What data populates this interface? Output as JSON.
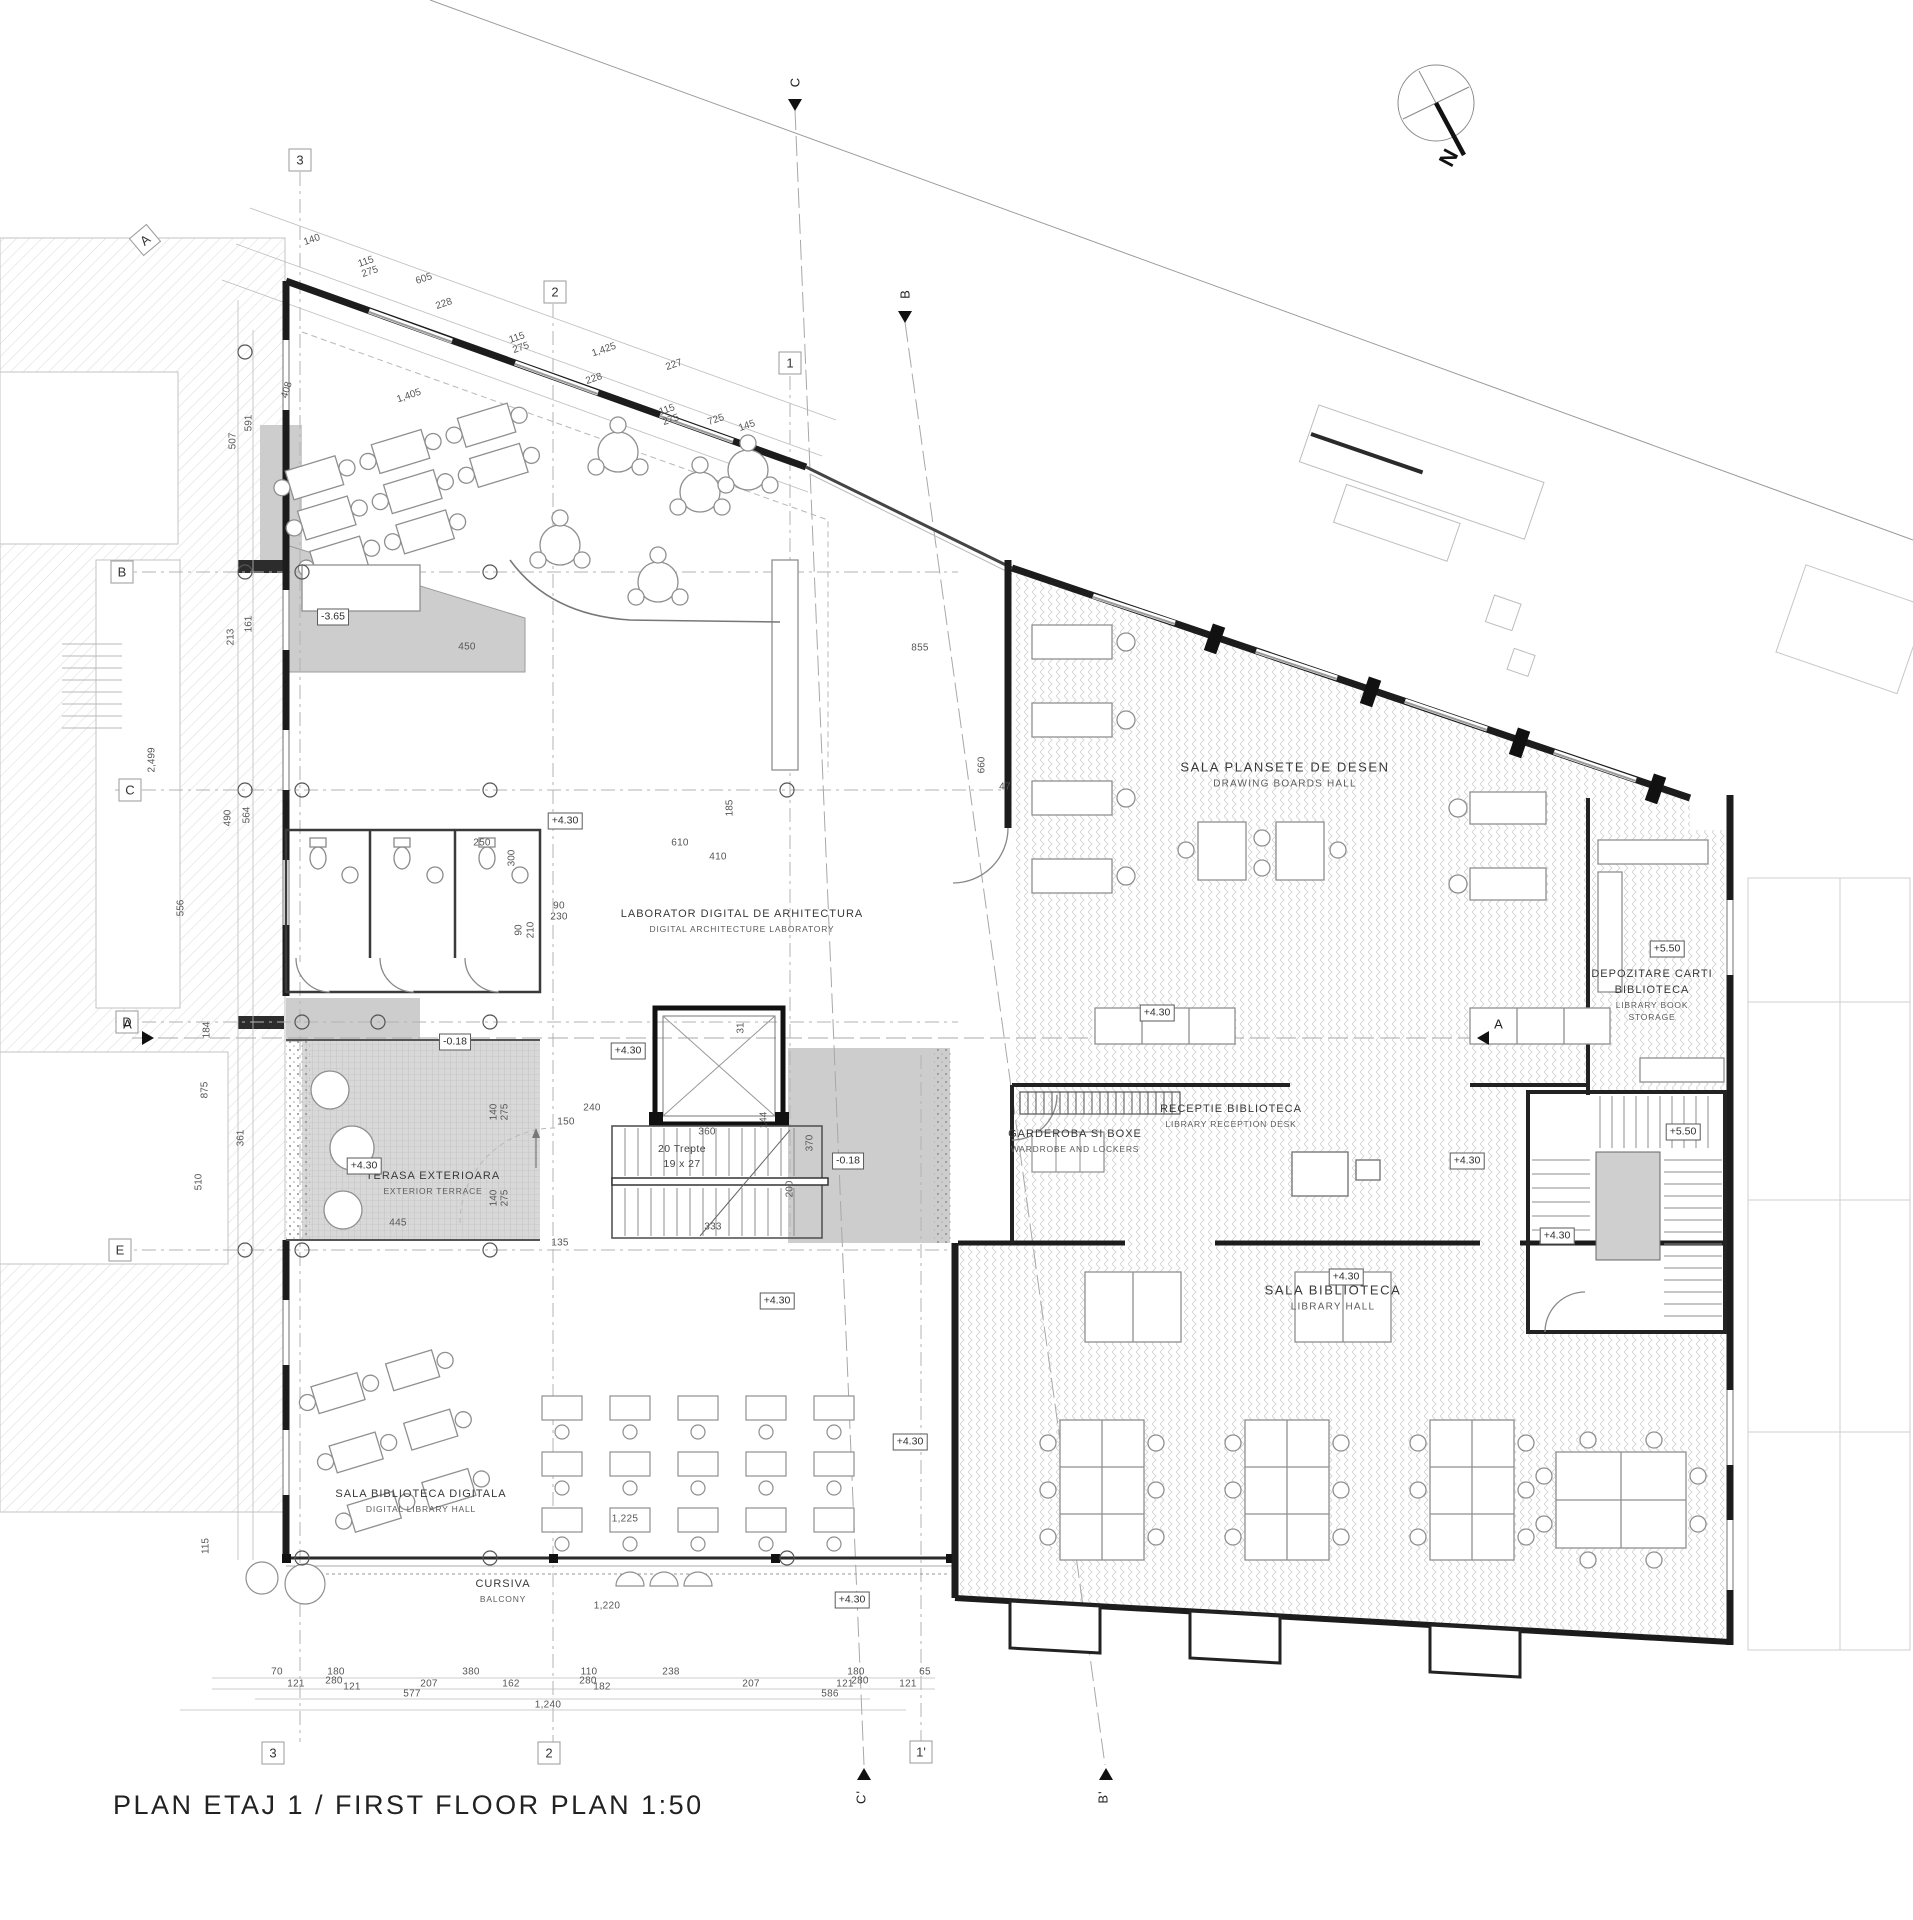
{
  "title": "PLAN ETAJ 1 / FIRST FLOOR PLAN 1:50",
  "compass": {
    "label": "N"
  },
  "rooms": {
    "drawing_boards": {
      "ro": "SALA PLANSETE DE DESEN",
      "en": "DRAWING BOARDS HALL"
    },
    "book_storage": {
      "ro1": "DEPOZITARE CARTI",
      "ro2": "BIBLIOTECA",
      "en1": "LIBRARY BOOK",
      "en2": "STORAGE"
    },
    "wardrobe": {
      "ro": "GARDEROBA SI BOXE",
      "en": "WARDROBE AND LOCKERS"
    },
    "reception": {
      "ro": "RECEPTIE BIBLIOTECA",
      "en": "LIBRARY RECEPTION DESK"
    },
    "library_hall": {
      "ro": "SALA BIBLIOTECA",
      "en": "LIBRARY HALL"
    },
    "digital_lab": {
      "ro": "LABORATOR DIGITAL DE ARHITECTURA",
      "en": "DIGITAL ARCHITECTURE LABORATORY"
    },
    "terrace": {
      "ro": "TERASA EXTERIOARA",
      "en": "EXTERIOR TERRACE"
    },
    "digital_library": {
      "ro": "SALA BIBLIOTECA DIGITALA",
      "en": "DIGITAL LIBRARY HALL"
    },
    "balcony": {
      "ro": "CURSIVA",
      "en": "BALCONY"
    },
    "stair_note": {
      "ro": "20 Trepte",
      "en": "19 x 27"
    }
  },
  "colors": {
    "wall": "#1c1c1c",
    "gray_fill": "#cdcdcd",
    "hatch": "#d9d9d9"
  },
  "annotations": [
    {
      "name": "elev-marker",
      "cls": "elev",
      "text": "-3.65",
      "x": 333,
      "y": 617
    },
    {
      "name": "elev-marker",
      "cls": "elev",
      "text": "+4.30",
      "x": 565,
      "y": 821
    },
    {
      "name": "elev-marker",
      "cls": "elev",
      "text": "-0.18",
      "x": 455,
      "y": 1042
    },
    {
      "name": "elev-marker",
      "cls": "elev",
      "text": "+4.30",
      "x": 364,
      "y": 1166
    },
    {
      "name": "elev-marker",
      "cls": "elev",
      "text": "-0.18",
      "x": 848,
      "y": 1161
    },
    {
      "name": "elev-marker",
      "cls": "elev",
      "text": "+4.30",
      "x": 628,
      "y": 1051
    },
    {
      "name": "elev-marker",
      "cls": "elev",
      "text": "+4.30",
      "x": 1157,
      "y": 1013
    },
    {
      "name": "elev-marker",
      "cls": "elev",
      "text": "+4.30",
      "x": 1467,
      "y": 1161
    },
    {
      "name": "elev-marker",
      "cls": "elev",
      "text": "+4.30",
      "x": 1557,
      "y": 1236
    },
    {
      "name": "elev-marker",
      "cls": "elev",
      "text": "+4.30",
      "x": 1346,
      "y": 1277
    },
    {
      "name": "elev-marker",
      "cls": "elev",
      "text": "+5.50",
      "x": 1667,
      "y": 949
    },
    {
      "name": "elev-marker",
      "cls": "elev",
      "text": "+5.50",
      "x": 1683,
      "y": 1132
    },
    {
      "name": "elev-marker",
      "cls": "elev",
      "text": "+4.30",
      "x": 777,
      "y": 1301
    },
    {
      "name": "elev-marker",
      "cls": "elev",
      "text": "+4.30",
      "x": 910,
      "y": 1442
    },
    {
      "name": "elev-marker",
      "cls": "elev",
      "text": "+4.30",
      "x": 852,
      "y": 1600
    },
    {
      "name": "grid-bubble",
      "cls": "bubble",
      "text": "3",
      "x": 300,
      "y": 160
    },
    {
      "name": "grid-bubble",
      "cls": "bubble",
      "text": "2",
      "x": 555,
      "y": 292
    },
    {
      "name": "grid-bubble",
      "cls": "bubble",
      "text": "1",
      "x": 790,
      "y": 363
    },
    {
      "name": "grid-bubble",
      "cls": "bubble",
      "text": "3",
      "x": 273,
      "y": 1753
    },
    {
      "name": "grid-bubble",
      "cls": "bubble",
      "text": "2",
      "x": 549,
      "y": 1753
    },
    {
      "name": "grid-bubble",
      "cls": "bubble",
      "text": "1'",
      "x": 921,
      "y": 1752
    },
    {
      "name": "grid-bubble",
      "cls": "bubble",
      "text": "A",
      "x": 145,
      "y": 240,
      "rot": -40
    },
    {
      "name": "grid-bubble",
      "cls": "bubble",
      "text": "B",
      "x": 122,
      "y": 572
    },
    {
      "name": "grid-bubble",
      "cls": "bubble",
      "text": "C",
      "x": 130,
      "y": 790
    },
    {
      "name": "grid-bubble",
      "cls": "bubble",
      "text": "D",
      "x": 127,
      "y": 1022
    },
    {
      "name": "grid-bubble",
      "cls": "bubble",
      "text": "E",
      "x": 120,
      "y": 1250
    },
    {
      "name": "section-label",
      "cls": "sec",
      "text": "C",
      "x": 795,
      "y": 82,
      "rot": -90
    },
    {
      "name": "section-label",
      "cls": "sec",
      "text": "B",
      "x": 905,
      "y": 294,
      "rot": -90
    },
    {
      "name": "section-label",
      "cls": "sec",
      "text": "C'",
      "x": 861,
      "y": 1797,
      "rot": -90
    },
    {
      "name": "section-label",
      "cls": "sec",
      "text": "B'",
      "x": 1103,
      "y": 1797,
      "rot": -90
    },
    {
      "name": "section-label",
      "cls": "sec",
      "text": "A",
      "x": 128,
      "y": 1024
    },
    {
      "name": "section-label",
      "cls": "sec",
      "text": "A",
      "x": 1499,
      "y": 1024
    },
    {
      "name": "section-arrow",
      "cls": "tri",
      "text": "",
      "x": 795,
      "y": 105
    },
    {
      "name": "section-arrow",
      "cls": "tri",
      "text": "",
      "x": 905,
      "y": 317
    },
    {
      "name": "section-arrow",
      "cls": "tri",
      "text": "",
      "x": 864,
      "y": 1774,
      "rot": 180
    },
    {
      "name": "section-arrow",
      "cls": "tri",
      "text": "",
      "x": 1106,
      "y": 1774,
      "rot": 180
    },
    {
      "name": "section-arrow",
      "cls": "tri",
      "text": "",
      "x": 148,
      "y": 1038,
      "rot": -90
    },
    {
      "name": "section-arrow",
      "cls": "tri",
      "text": "",
      "x": 1483,
      "y": 1038,
      "rot": 90
    },
    {
      "name": "dim",
      "cls": "dim",
      "text": "70",
      "x": 277,
      "y": 1672
    },
    {
      "name": "dim",
      "cls": "dim",
      "text": "180",
      "x": 336,
      "y": 1672
    },
    {
      "name": "dim",
      "cls": "dim",
      "text": "380",
      "x": 471,
      "y": 1672
    },
    {
      "name": "dim",
      "cls": "dim",
      "text": "110",
      "x": 589,
      "y": 1672
    },
    {
      "name": "dim",
      "cls": "dim",
      "text": "238",
      "x": 671,
      "y": 1672
    },
    {
      "name": "dim",
      "cls": "dim",
      "text": "180",
      "x": 856,
      "y": 1672
    },
    {
      "name": "dim",
      "cls": "dim",
      "text": "65",
      "x": 925,
      "y": 1672
    },
    {
      "name": "dim",
      "cls": "dim",
      "text": "121",
      "x": 296,
      "y": 1684
    },
    {
      "name": "dim",
      "cls": "dim",
      "text": "280",
      "x": 334,
      "y": 1681
    },
    {
      "name": "dim",
      "cls": "dim",
      "text": "121",
      "x": 352,
      "y": 1687
    },
    {
      "name": "dim",
      "cls": "dim",
      "text": "207",
      "x": 429,
      "y": 1684
    },
    {
      "name": "dim",
      "cls": "dim",
      "text": "162",
      "x": 511,
      "y": 1684
    },
    {
      "name": "dim",
      "cls": "dim",
      "text": "280",
      "x": 588,
      "y": 1681
    },
    {
      "name": "dim",
      "cls": "dim",
      "text": "182",
      "x": 602,
      "y": 1687
    },
    {
      "name": "dim",
      "cls": "dim",
      "text": "207",
      "x": 751,
      "y": 1684
    },
    {
      "name": "dim",
      "cls": "dim",
      "text": "121",
      "x": 845,
      "y": 1684
    },
    {
      "name": "dim",
      "cls": "dim",
      "text": "280",
      "x": 860,
      "y": 1681
    },
    {
      "name": "dim",
      "cls": "dim",
      "text": "121",
      "x": 908,
      "y": 1684
    },
    {
      "name": "dim",
      "cls": "dim",
      "text": "577",
      "x": 412,
      "y": 1694
    },
    {
      "name": "dim",
      "cls": "dim",
      "text": "586",
      "x": 830,
      "y": 1694
    },
    {
      "name": "dim",
      "cls": "dim",
      "text": "1,240",
      "x": 548,
      "y": 1705
    },
    {
      "name": "dim",
      "cls": "dimv",
      "text": "591",
      "x": 249,
      "y": 423,
      "rot": -90
    },
    {
      "name": "dim",
      "cls": "dimv",
      "text": "507",
      "x": 233,
      "y": 441,
      "rot": -90
    },
    {
      "name": "dim",
      "cls": "dimv",
      "text": "408",
      "x": 287,
      "y": 390,
      "rot": -73
    },
    {
      "name": "dim",
      "cls": "dimv",
      "text": "213",
      "x": 231,
      "y": 637,
      "rot": -90
    },
    {
      "name": "dim",
      "cls": "dimv",
      "text": "161",
      "x": 249,
      "y": 624,
      "rot": -90
    },
    {
      "name": "dim",
      "cls": "dimv",
      "text": "490",
      "x": 228,
      "y": 818,
      "rot": -90
    },
    {
      "name": "dim",
      "cls": "dimv",
      "text": "564",
      "x": 247,
      "y": 815,
      "rot": -90
    },
    {
      "name": "dim",
      "cls": "dimv",
      "text": "2,499",
      "x": 152,
      "y": 760,
      "rot": -90
    },
    {
      "name": "dim",
      "cls": "dimv",
      "text": "184",
      "x": 207,
      "y": 1030,
      "rot": -90
    },
    {
      "name": "dim",
      "cls": "dimv",
      "text": "556",
      "x": 181,
      "y": 908,
      "rot": -90
    },
    {
      "name": "dim",
      "cls": "dimv",
      "text": "875",
      "x": 205,
      "y": 1090,
      "rot": -90
    },
    {
      "name": "dim",
      "cls": "dimv",
      "text": "510",
      "x": 199,
      "y": 1182,
      "rot": -90
    },
    {
      "name": "dim",
      "cls": "dimv",
      "text": "361",
      "x": 241,
      "y": 1138,
      "rot": -90
    },
    {
      "name": "dim",
      "cls": "dimv",
      "text": "115",
      "x": 206,
      "y": 1546,
      "rot": -90
    },
    {
      "name": "dim",
      "cls": "dims",
      "text": "140",
      "x": 312,
      "y": 240,
      "rot": -19
    },
    {
      "name": "dim",
      "cls": "dims",
      "text": "115",
      "x": 366,
      "y": 262,
      "rot": -19
    },
    {
      "name": "dim",
      "cls": "dims",
      "text": "275",
      "x": 370,
      "y": 272,
      "rot": -19
    },
    {
      "name": "dim",
      "cls": "dims",
      "text": "605",
      "x": 424,
      "y": 279,
      "rot": -19
    },
    {
      "name": "dim",
      "cls": "dims",
      "text": "228",
      "x": 444,
      "y": 304,
      "rot": -19
    },
    {
      "name": "dim",
      "cls": "dims",
      "text": "1,405",
      "x": 409,
      "y": 396,
      "rot": -19
    },
    {
      "name": "dim",
      "cls": "dims",
      "text": "115",
      "x": 517,
      "y": 338,
      "rot": -19
    },
    {
      "name": "dim",
      "cls": "dims",
      "text": "275",
      "x": 521,
      "y": 348,
      "rot": -19
    },
    {
      "name": "dim",
      "cls": "dims",
      "text": "1,425",
      "x": 604,
      "y": 350,
      "rot": -19
    },
    {
      "name": "dim",
      "cls": "dims",
      "text": "228",
      "x": 594,
      "y": 379,
      "rot": -19
    },
    {
      "name": "dim",
      "cls": "dims",
      "text": "227",
      "x": 674,
      "y": 365,
      "rot": -19
    },
    {
      "name": "dim",
      "cls": "dims",
      "text": "115",
      "x": 667,
      "y": 410,
      "rot": -19
    },
    {
      "name": "dim",
      "cls": "dims",
      "text": "275",
      "x": 671,
      "y": 420,
      "rot": -19
    },
    {
      "name": "dim",
      "cls": "dims",
      "text": "725",
      "x": 716,
      "y": 420,
      "rot": -19
    },
    {
      "name": "dim",
      "cls": "dims",
      "text": "145",
      "x": 747,
      "y": 426,
      "rot": -19
    },
    {
      "name": "dim",
      "cls": "dim",
      "text": "450",
      "x": 467,
      "y": 647
    },
    {
      "name": "dim",
      "cls": "dim",
      "text": "855",
      "x": 920,
      "y": 648
    },
    {
      "name": "dim",
      "cls": "dim",
      "text": "250",
      "x": 482,
      "y": 843
    },
    {
      "name": "dim",
      "cls": "dimv",
      "text": "300",
      "x": 512,
      "y": 858,
      "rot": -90
    },
    {
      "name": "dim",
      "cls": "dim",
      "text": "610",
      "x": 680,
      "y": 843
    },
    {
      "name": "dim",
      "cls": "dim",
      "text": "410",
      "x": 718,
      "y": 857
    },
    {
      "name": "dim",
      "cls": "dimv",
      "text": "185",
      "x": 730,
      "y": 808,
      "rot": -90
    },
    {
      "name": "dim",
      "cls": "dim",
      "text": "90",
      "x": 559,
      "y": 906
    },
    {
      "name": "dim",
      "cls": "dim",
      "text": "230",
      "x": 559,
      "y": 917
    },
    {
      "name": "dim",
      "cls": "dimv",
      "text": "90",
      "x": 519,
      "y": 930,
      "rot": -90
    },
    {
      "name": "dim",
      "cls": "dimv",
      "text": "210",
      "x": 531,
      "y": 930,
      "rot": -90
    },
    {
      "name": "dim",
      "cls": "dim",
      "text": "47",
      "x": 1005,
      "y": 787
    },
    {
      "name": "dim",
      "cls": "dimv",
      "text": "660",
      "x": 982,
      "y": 765,
      "rot": -90
    },
    {
      "name": "dim",
      "cls": "dim",
      "text": "240",
      "x": 592,
      "y": 1108
    },
    {
      "name": "dim",
      "cls": "dim",
      "text": "150",
      "x": 566,
      "y": 1122
    },
    {
      "name": "dim",
      "cls": "dim",
      "text": "135",
      "x": 560,
      "y": 1243
    },
    {
      "name": "dim",
      "cls": "dim",
      "text": "360",
      "x": 707,
      "y": 1132
    },
    {
      "name": "dim",
      "cls": "dimv",
      "text": "370",
      "x": 810,
      "y": 1143,
      "rot": -90
    },
    {
      "name": "dim",
      "cls": "dimv",
      "text": "200",
      "x": 790,
      "y": 1189,
      "rot": -90
    },
    {
      "name": "dim",
      "cls": "dim",
      "text": "333",
      "x": 713,
      "y": 1227
    },
    {
      "name": "dim",
      "cls": "dimv",
      "text": "31",
      "x": 741,
      "y": 1028,
      "rot": -90
    },
    {
      "name": "dim",
      "cls": "dim",
      "text": "445",
      "x": 398,
      "y": 1223
    },
    {
      "name": "dim",
      "cls": "dimv",
      "text": "140",
      "x": 494,
      "y": 1112,
      "rot": -90
    },
    {
      "name": "dim",
      "cls": "dimv",
      "text": "275",
      "x": 505,
      "y": 1112,
      "rot": -90
    },
    {
      "name": "dim",
      "cls": "dimv",
      "text": "140",
      "x": 494,
      "y": 1198,
      "rot": -90
    },
    {
      "name": "dim",
      "cls": "dimv",
      "text": "275",
      "x": 505,
      "y": 1198,
      "rot": -90
    },
    {
      "name": "dim",
      "cls": "dim",
      "text": "1,225",
      "x": 625,
      "y": 1519
    },
    {
      "name": "dim",
      "cls": "dim",
      "text": "1,220",
      "x": 607,
      "y": 1606
    },
    {
      "name": "dim",
      "cls": "dimv",
      "text": "144",
      "x": 764,
      "y": 1120,
      "rot": -90
    }
  ]
}
